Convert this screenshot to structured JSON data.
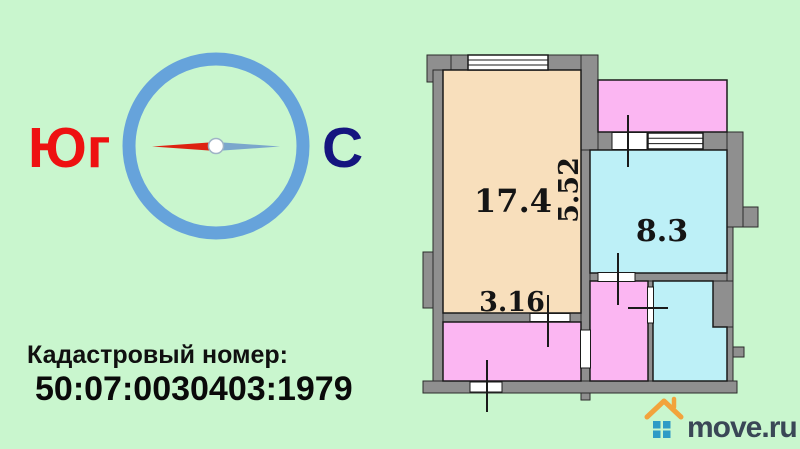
{
  "colors": {
    "background": "#C9F6CE",
    "wall": "#8F8F8F",
    "outline": "#2B2B2B",
    "room_beige": "#F8DFBC",
    "room_pink": "#FBB6F2",
    "room_cyan": "#BDF0F7",
    "compass_ring": "#66A3DB",
    "needle_south_red": "#DD2211",
    "needle_north_blue": "#7BA7CC",
    "south_label_red": "#EE1111",
    "north_label_navy": "#15157F",
    "body_text": "#0A0A0A",
    "logo_roof_orange": "#F2A33C",
    "logo_windows_blue": "#2E9BC6",
    "logo_text_slate": "#3A4756"
  },
  "compass": {
    "south_label": "Юг",
    "north_label": "С"
  },
  "cadastral": {
    "label": "Кадастровый номер:",
    "number": "50:07:0030403:1979"
  },
  "floor_plan": {
    "labels": {
      "living_area": "17.4",
      "living_height": "5.52",
      "living_width": "3.16",
      "second_room_area": "8.3"
    }
  },
  "logo": {
    "text": "move.ru"
  }
}
